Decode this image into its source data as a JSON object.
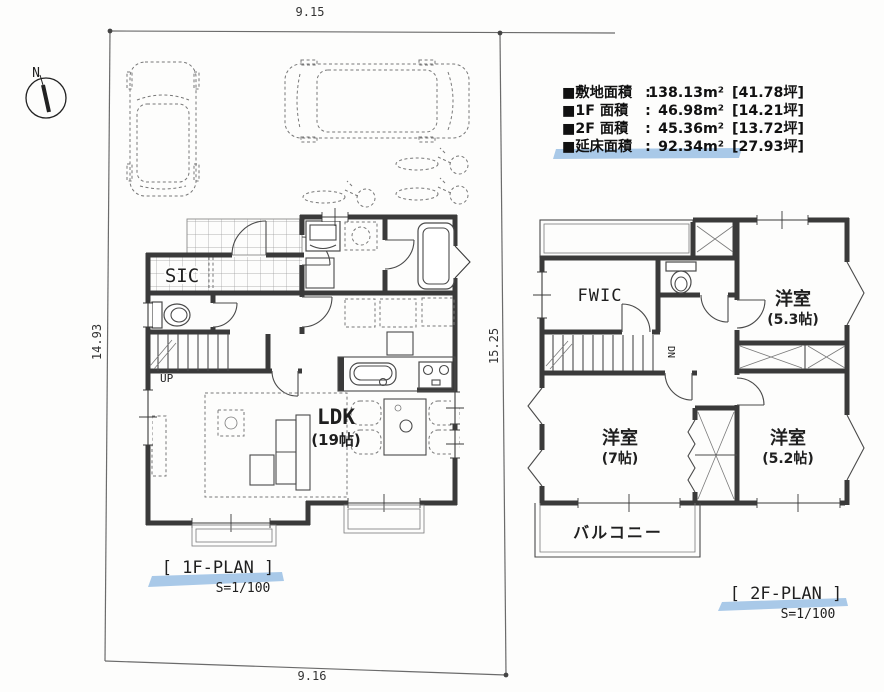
{
  "meta": {
    "highlight_color": "#a9c9e8",
    "wall_color": "#3a3a3a"
  },
  "compass": {
    "north": "N"
  },
  "site_dimensions": {
    "top": "9.15",
    "left": "14.93",
    "right": "15.25",
    "bottom": "9.16"
  },
  "area_summary": {
    "rows": [
      {
        "label": "■敷地面積",
        "colon": ":",
        "value": "138.13m²",
        "tsubo": "[41.78坪]"
      },
      {
        "label": "■1F 面積",
        "colon": ":",
        "value": "46.98m²",
        "tsubo": "[14.21坪]"
      },
      {
        "label": "■2F 面積",
        "colon": ":",
        "value": "45.36m²",
        "tsubo": "[13.72坪]"
      },
      {
        "label": "■延床面積",
        "colon": ":",
        "value": "92.34m²",
        "tsubo": "[27.93坪]"
      }
    ]
  },
  "floor1": {
    "title": "[ 1F-PLAN ]",
    "scale": "S=1/100",
    "labels": {
      "sic": "SIC",
      "up": "UP",
      "ldk": "LDK",
      "ldk_size": "(19帖)"
    }
  },
  "floor2": {
    "title": "[ 2F-PLAN ]",
    "scale": "S=1/100",
    "labels": {
      "fwic": "FWIC",
      "dn": "DN",
      "room_a": "洋室",
      "room_a_size": "(5.3帖)",
      "room_b": "洋室",
      "room_b_size": "(7帖)",
      "room_c": "洋室",
      "room_c_size": "(5.2帖)",
      "balcony": "バルコニー"
    }
  }
}
